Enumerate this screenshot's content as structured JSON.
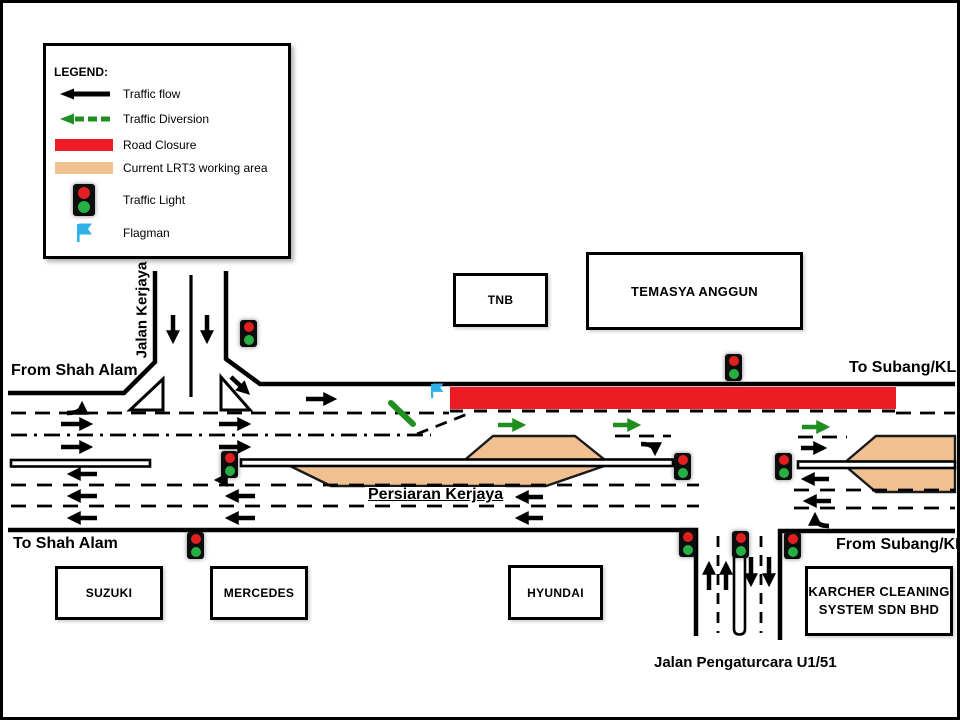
{
  "legend": {
    "title": "LEGEND:",
    "items": [
      {
        "icon": "traffic-flow-arrow-icon",
        "label": "Traffic flow"
      },
      {
        "icon": "traffic-diversion-arrow-icon",
        "label": "Traffic Diversion"
      },
      {
        "icon": "road-closure-bar-icon",
        "label": "Road Closure"
      },
      {
        "icon": "working-area-bar-icon",
        "label": "Current LRT3 working area"
      },
      {
        "icon": "traffic-light-icon",
        "label": "Traffic Light"
      },
      {
        "icon": "flagman-icon",
        "label": "Flagman"
      }
    ]
  },
  "roads": {
    "jalan_kerjaya": "Jalan Kerjaya",
    "from_shah_alam": "From Shah Alam",
    "to_subang_kl": "To Subang/KL",
    "to_shah_alam": "To Shah Alam",
    "from_subang_kl": "From Subang/KL",
    "persiaran_kerjaya": "Persiaran Kerjaya",
    "jalan_pengaturcara": "Jalan Pengaturcara U1/51"
  },
  "buildings": {
    "tnb": "TNB",
    "temasya_anggun": "TEMASYA ANGGUN",
    "suzuki": "SUZUKI",
    "mercedes": "MERCEDES",
    "hyundai": "HYUNDAI",
    "karcher_line1": "KARCHER CLEANING",
    "karcher_line2": "SYSTEM SDN BHD"
  },
  "colors": {
    "road_closure_red": "#ED1C24",
    "working_area_tan": "#F0C091",
    "diversion_green": "#1F8F1F",
    "flag_blue": "#2FB1E8",
    "signal_red": "#E02020",
    "signal_green": "#27AE45"
  }
}
